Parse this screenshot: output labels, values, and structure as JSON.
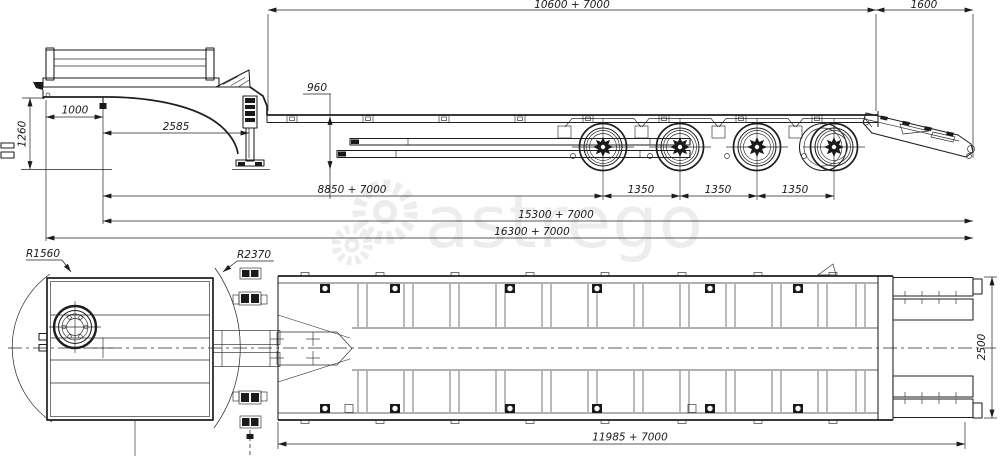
{
  "meta": {
    "watermark": "astrego",
    "drawing_type": "lowbed semitrailer two-view technical drawing",
    "colors": {
      "line": "#1e1e1e",
      "background": "#ffffff",
      "watermark": "#ededed"
    }
  },
  "side_view": {
    "axle_count": 4,
    "dims": {
      "upper_main": "10600 + 7000",
      "rear_overhang": "1600",
      "deck_height": "960",
      "front_overhang": "1000",
      "coupling_height": "1260",
      "gooseneck": "2585",
      "kingpin_to_axle1": "8850 + 7000",
      "axle_gap_1": "1350",
      "axle_gap_2": "1350",
      "axle_gap_3": "1350",
      "kingpin_to_rear": "15300 + 7000",
      "overall": "16300 + 7000"
    }
  },
  "plan_view": {
    "dims": {
      "front_radius": "R1560",
      "gooseneck_radius": "R2370",
      "width": "2500",
      "platform": "11985 + 7000"
    }
  }
}
